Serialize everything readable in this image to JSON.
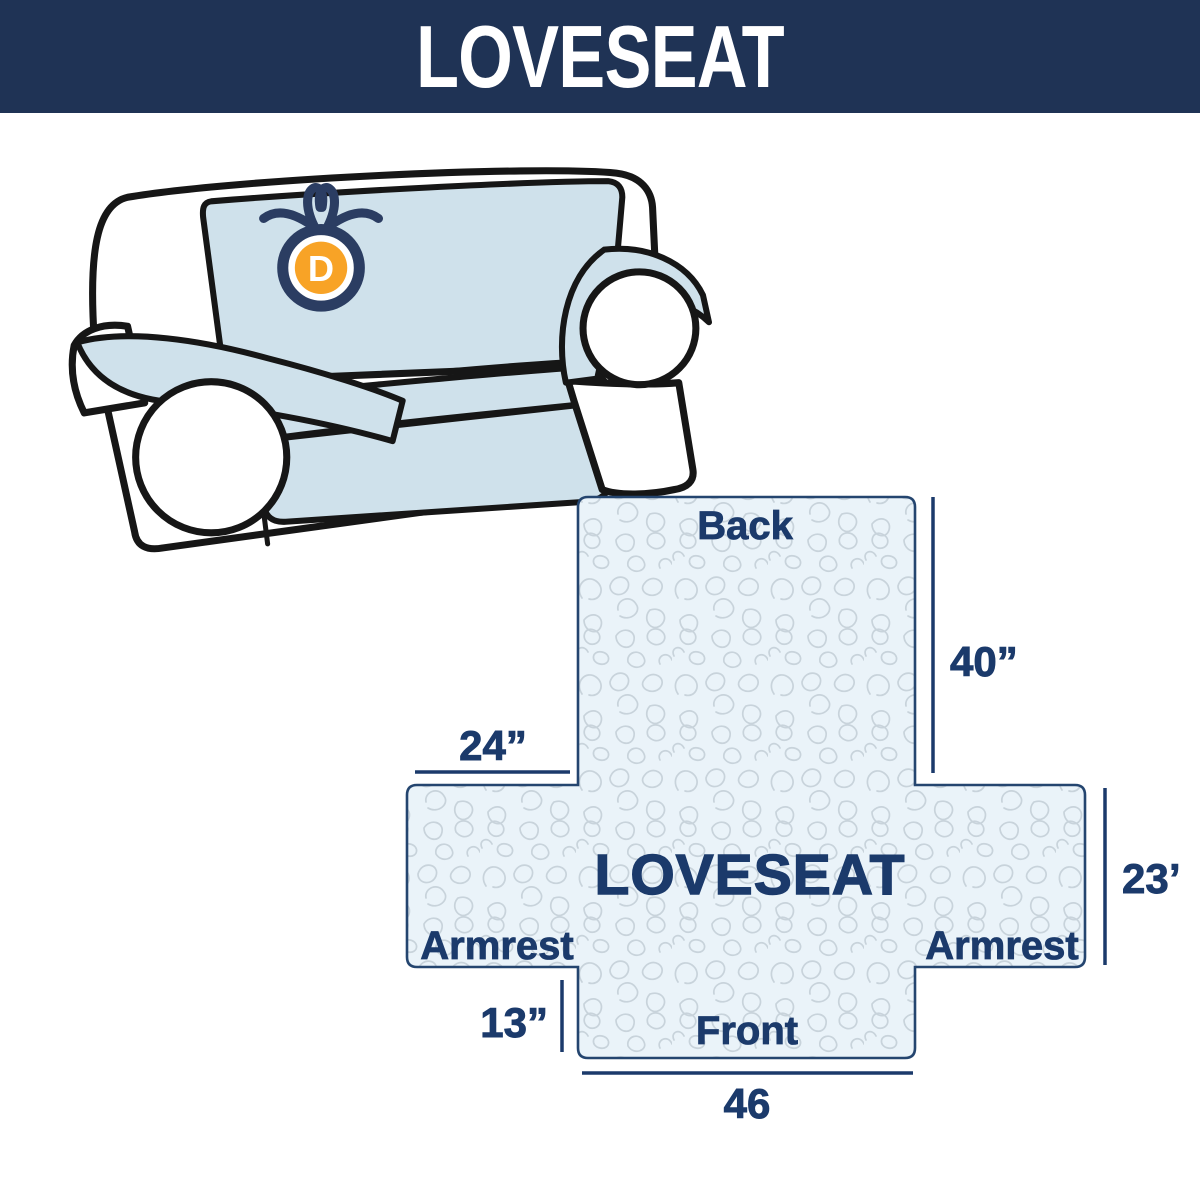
{
  "header": {
    "title": "LOVESEAT",
    "bg_color": "#1f3355",
    "text_color": "#ffffff"
  },
  "illustration": {
    "description": "loveseat sofa with light blue protective cover draped over back, seat and armrests",
    "cover_color": "#cfe1eb",
    "body_color": "#ffffff",
    "outline_color": "#161616",
    "logo": {
      "letter": "D",
      "badge_color": "#f8a326",
      "ribbon_color": "#2b3d62",
      "letter_color": "#ffffff"
    }
  },
  "diagram": {
    "center_label": "LOVESEAT",
    "back_label": "Back",
    "front_label": "Front",
    "left_armrest_label": "Armrest",
    "right_armrest_label": "Armrest",
    "dim_back_height": "40”",
    "dim_armrest_width": "24”",
    "dim_armrest_height": "23”",
    "dim_front_drop": "13”",
    "dim_front_width": "46",
    "fill_color": "#eaf3f9",
    "pattern_color": "#c8d3db",
    "accent_color": "#1b3a6b"
  }
}
